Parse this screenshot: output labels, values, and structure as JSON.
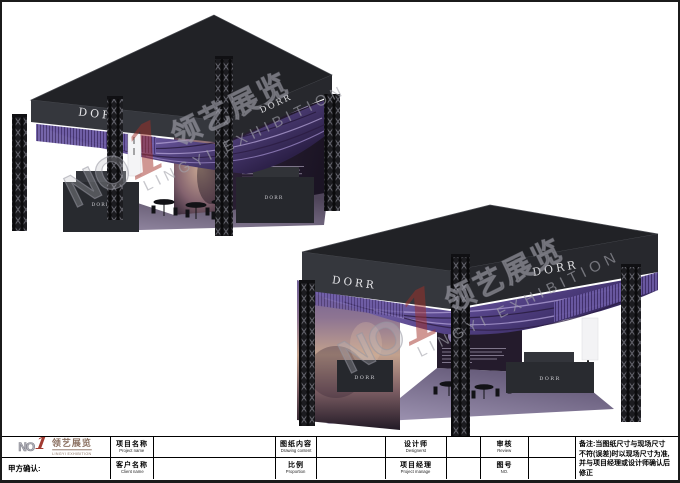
{
  "booth": {
    "brand": "DORR",
    "aura": "AURA"
  },
  "watermark": {
    "no": "NO",
    "one": "1",
    "cn": "领艺展览",
    "en": "LINGYI EXHIBITION"
  },
  "title_block": {
    "logo": {
      "no": "NO",
      "one": "1",
      "cn": "领艺展览",
      "en": "LINGYI EXHIBITION"
    },
    "party_confirm": "甲方确认:",
    "project_name": {
      "cn": "项目名称",
      "en": "Project name",
      "value": ""
    },
    "client_name": {
      "cn": "客户名称",
      "en": "Client name",
      "value": ""
    },
    "drawing_content": {
      "cn": "图纸内容",
      "en": "Drawing content",
      "value": ""
    },
    "proportion": {
      "cn": "比例",
      "en": "Proportion",
      "value": ""
    },
    "designer": {
      "cn": "设计师",
      "en": "Designerst",
      "value": ""
    },
    "project_manager": {
      "cn": "项目经理",
      "en": "Project manage",
      "value": ""
    },
    "review": {
      "cn": "审核",
      "en": "Review",
      "value": ""
    },
    "drawing_no": {
      "cn": "图号",
      "en": "NO.",
      "value": ""
    },
    "notes_lines": [
      "备注:当图纸尺寸与现场尺寸",
      "不符(误差)时以现场尺寸为准,",
      "并与项目经理或设计师确认后",
      "修正"
    ]
  }
}
